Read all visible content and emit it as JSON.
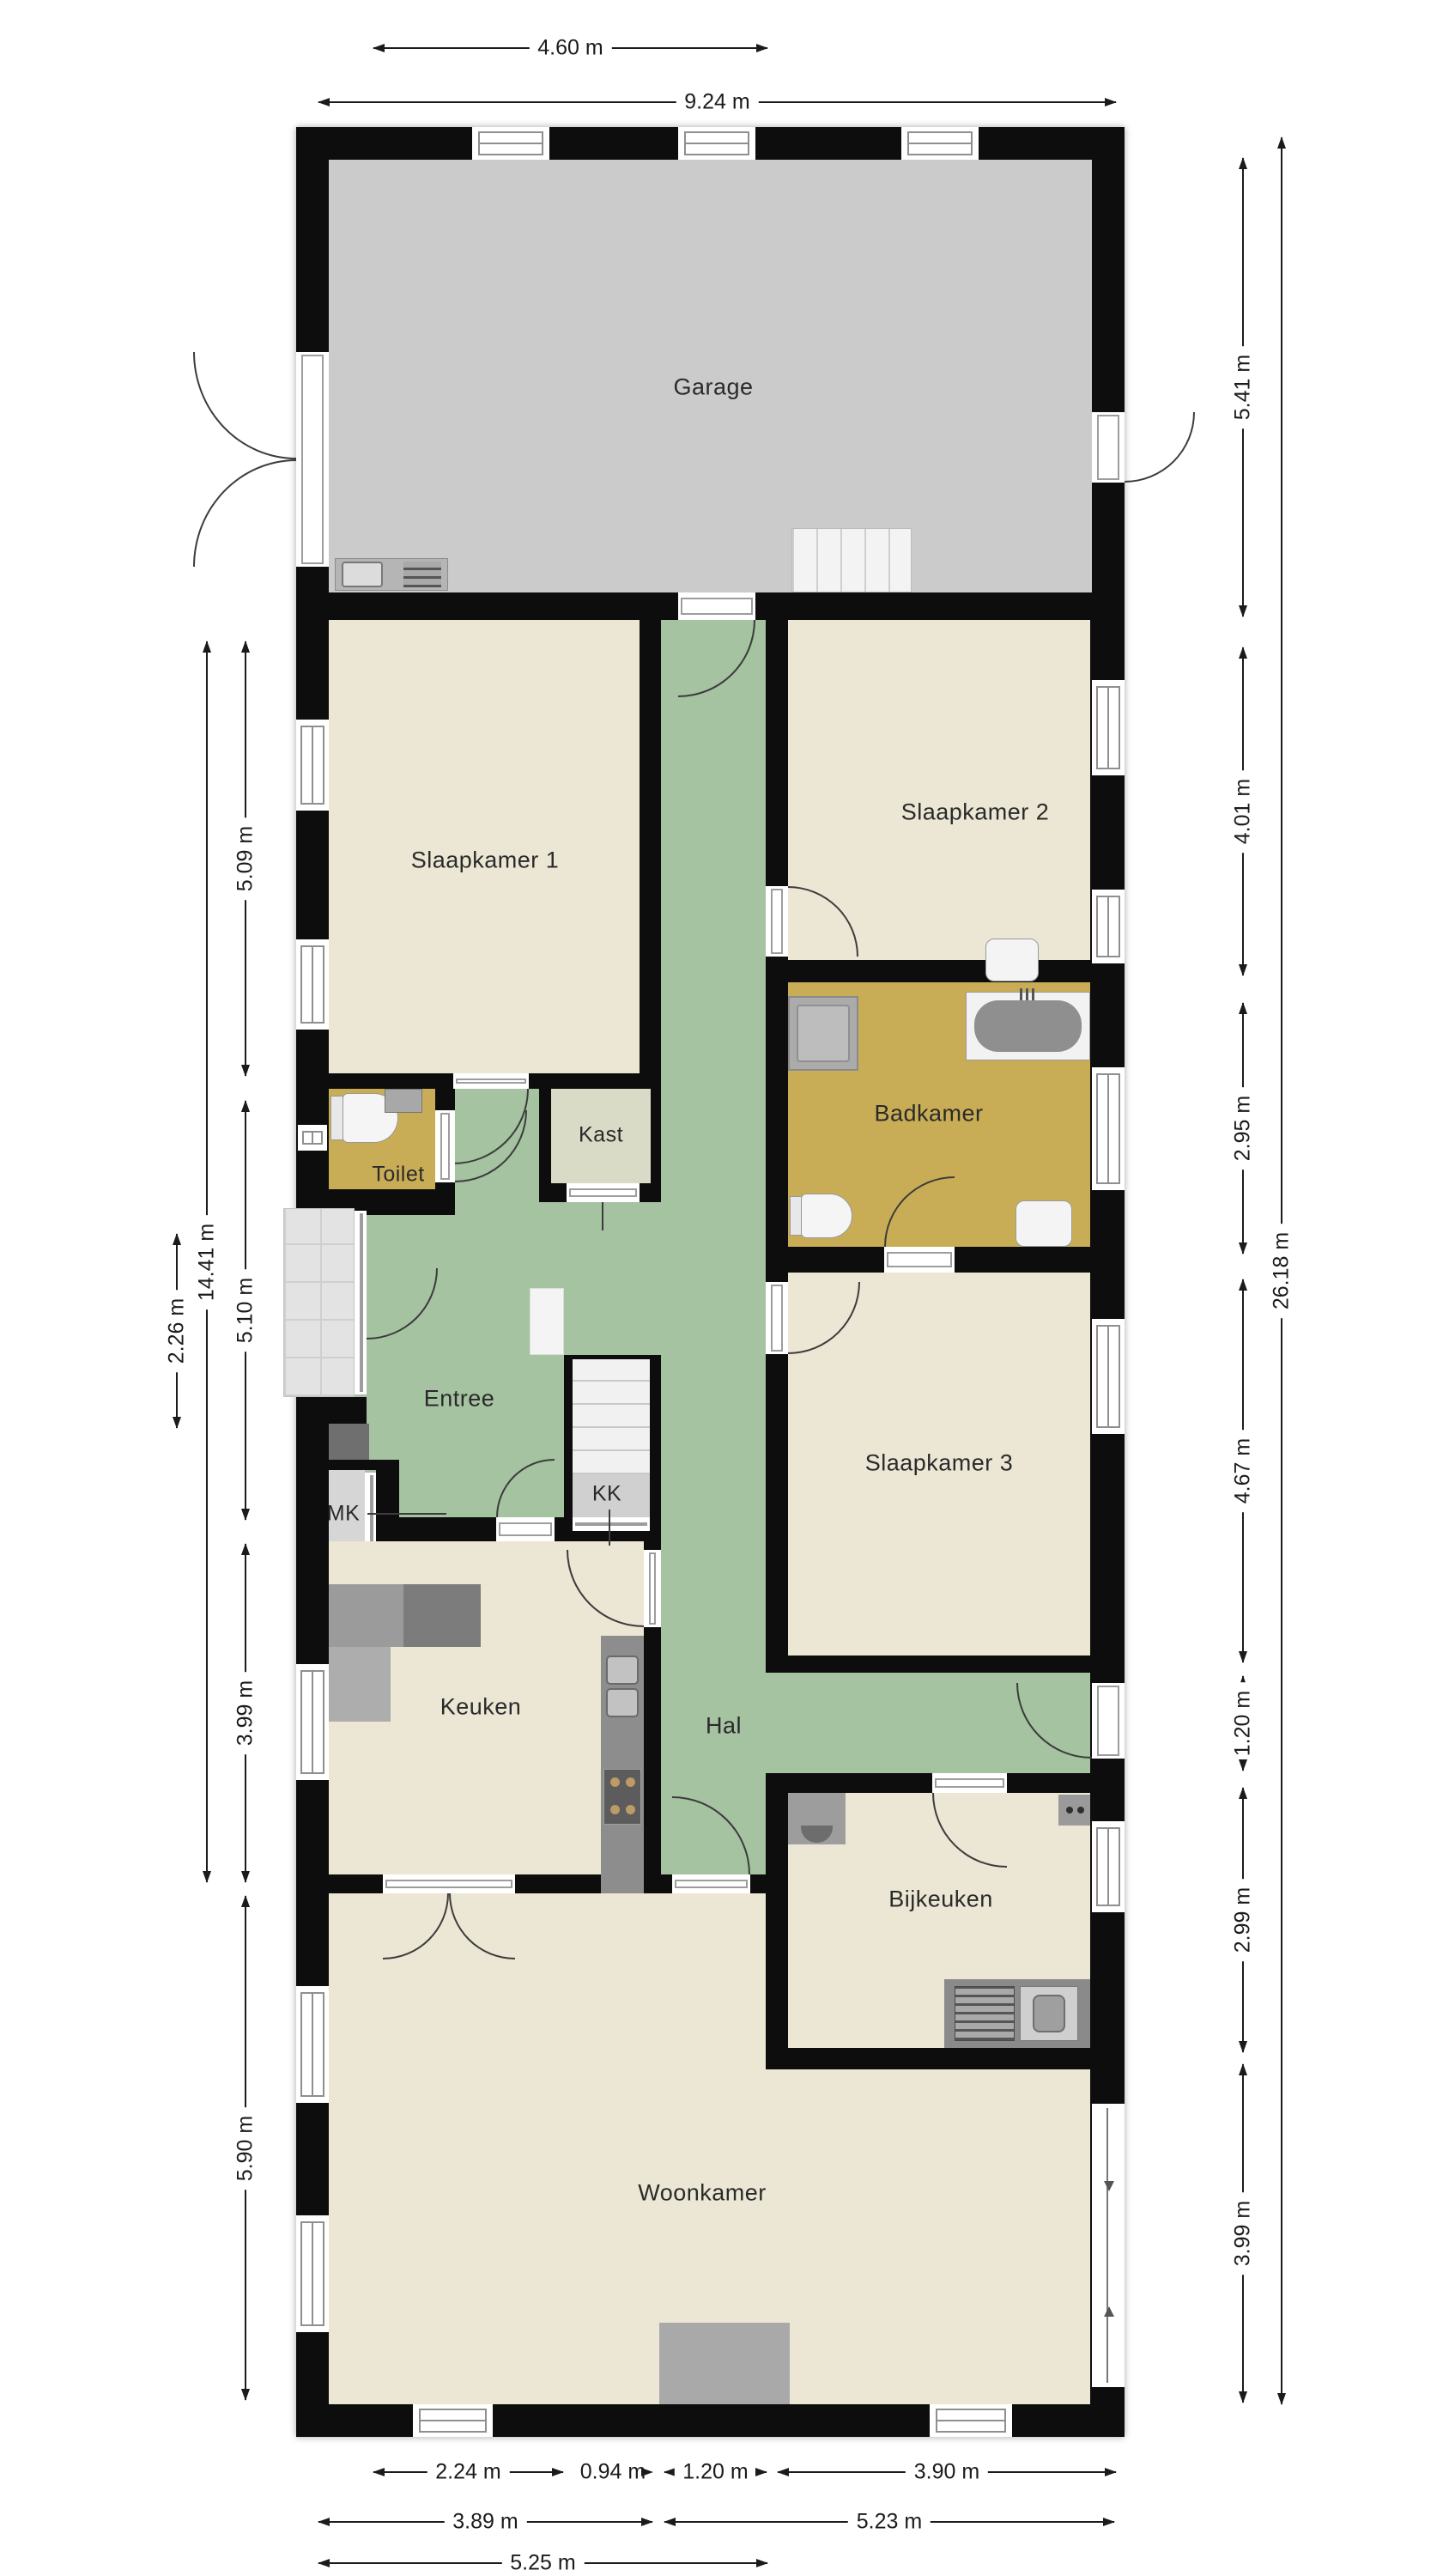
{
  "plan_type": "floorplan",
  "rooms": {
    "garage": {
      "label": "Garage"
    },
    "slaapkamer1": {
      "label": "Slaapkamer 1"
    },
    "slaapkamer2": {
      "label": "Slaapkamer 2"
    },
    "slaapkamer3": {
      "label": "Slaapkamer 3"
    },
    "badkamer": {
      "label": "Badkamer"
    },
    "toilet": {
      "label": "Toilet"
    },
    "kast": {
      "label": "Kast"
    },
    "entree": {
      "label": "Entree"
    },
    "mk": {
      "label": "MK"
    },
    "kk": {
      "label": "KK"
    },
    "keuken": {
      "label": "Keuken"
    },
    "hal": {
      "label": "Hal"
    },
    "bijkeuken": {
      "label": "Bijkeuken"
    },
    "woonkamer": {
      "label": "Woonkamer"
    }
  },
  "dimensions": {
    "top": [
      {
        "label": "4.60 m"
      },
      {
        "label": "9.24 m"
      }
    ],
    "left": [
      {
        "label": "5.09 m"
      },
      {
        "label": "5.10 m"
      },
      {
        "label": "3.99 m"
      },
      {
        "label": "5.90 m"
      },
      {
        "label": "14.41 m"
      },
      {
        "label": "2.26 m"
      }
    ],
    "right": [
      {
        "label": "5.41 m"
      },
      {
        "label": "4.01 m"
      },
      {
        "label": "2.95 m"
      },
      {
        "label": "4.67 m"
      },
      {
        "label": "1.20 m"
      },
      {
        "label": "2.99 m"
      },
      {
        "label": "3.99 m"
      },
      {
        "label": "26.18 m"
      }
    ],
    "bottom": [
      {
        "label": "2.24 m"
      },
      {
        "label": "0.94 m"
      },
      {
        "label": "1.20 m"
      },
      {
        "label": "3.90 m"
      },
      {
        "label": "3.89 m"
      },
      {
        "label": "5.23 m"
      },
      {
        "label": "5.25 m"
      }
    ]
  },
  "colors": {
    "wall": "#0d0d0d",
    "room_cream": "#ece7d4",
    "hallway_green": "#a5c2a1",
    "bathroom_gold": "#c9ad56",
    "garage_gray": "#cbcbcb",
    "closet_sage": "#d9dbc6",
    "porch_tile": "#e3e3e3",
    "dimension_text": "#1b1b1b"
  }
}
